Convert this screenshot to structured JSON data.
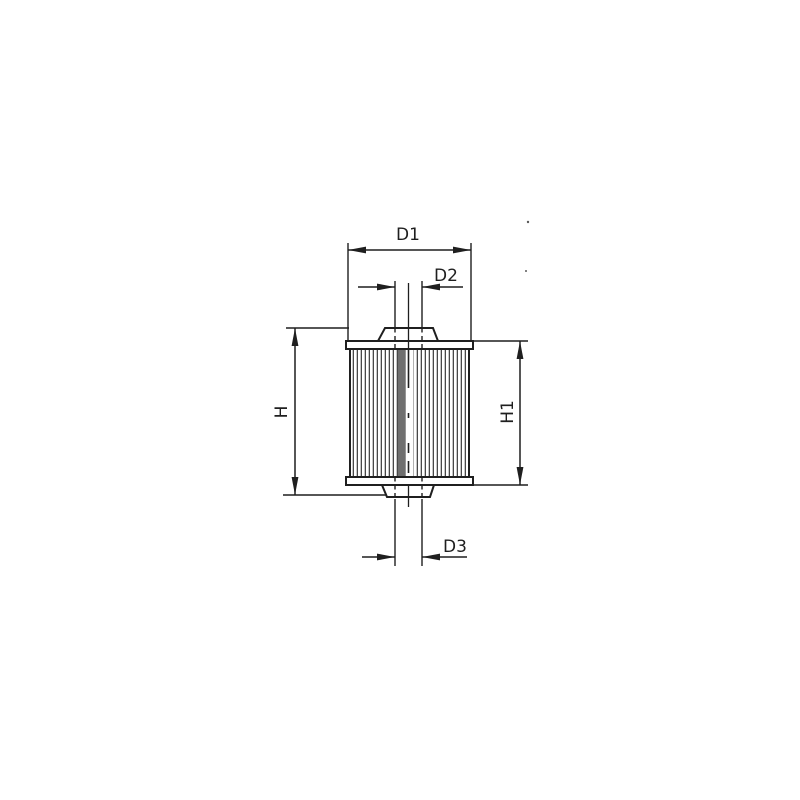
{
  "page": {
    "background": "#ffffff"
  },
  "drawing": {
    "line_color": "#1f1f1f",
    "labels": {
      "d1": "D1",
      "d2": "D2",
      "d3": "D3",
      "h": "H",
      "h1": "H1"
    }
  }
}
